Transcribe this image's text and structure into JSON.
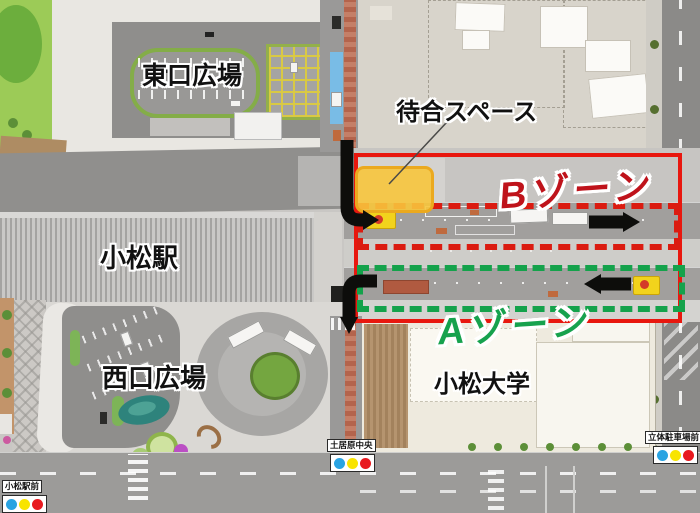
{
  "map": {
    "area_labels": {
      "east_plaza": "東口広場",
      "station": "小松駅",
      "west_plaza": "西口広場",
      "university": "小松大学"
    },
    "annotations": {
      "waiting_space_label": "待合スペース",
      "boundary_color": "#e8170e",
      "waiting_space_fill": "rgba(247,197,60,0.9)",
      "waiting_space_border": "#eba91e",
      "zone_b": {
        "label": "Bゾーン",
        "text_color": "#bf131b",
        "dash_color": "#db1b10",
        "flow_direction": "right"
      },
      "zone_a": {
        "label": "Aゾーン",
        "text_color": "#17a24e",
        "dash_color": "#14a24b",
        "flow_direction": "left"
      }
    },
    "icons": {
      "zone_b_flow": "arrow-right",
      "zone_a_flow": "arrow-left",
      "entry_flow": "arrow-elbow-down-right",
      "exit_flow": "arrow-elbow-down"
    },
    "bus_stops": [
      {
        "name": "小松駅前",
        "dot_colors": [
          "#29a3e2",
          "#f8e400",
          "#e8191f"
        ]
      },
      {
        "name": "土居原中央",
        "dot_colors": [
          "#29a3e2",
          "#f8e400",
          "#e8191f"
        ]
      },
      {
        "name": "立体駐車場前",
        "dot_colors": [
          "#29a3e2",
          "#f8e400",
          "#e8191f"
        ]
      }
    ]
  }
}
